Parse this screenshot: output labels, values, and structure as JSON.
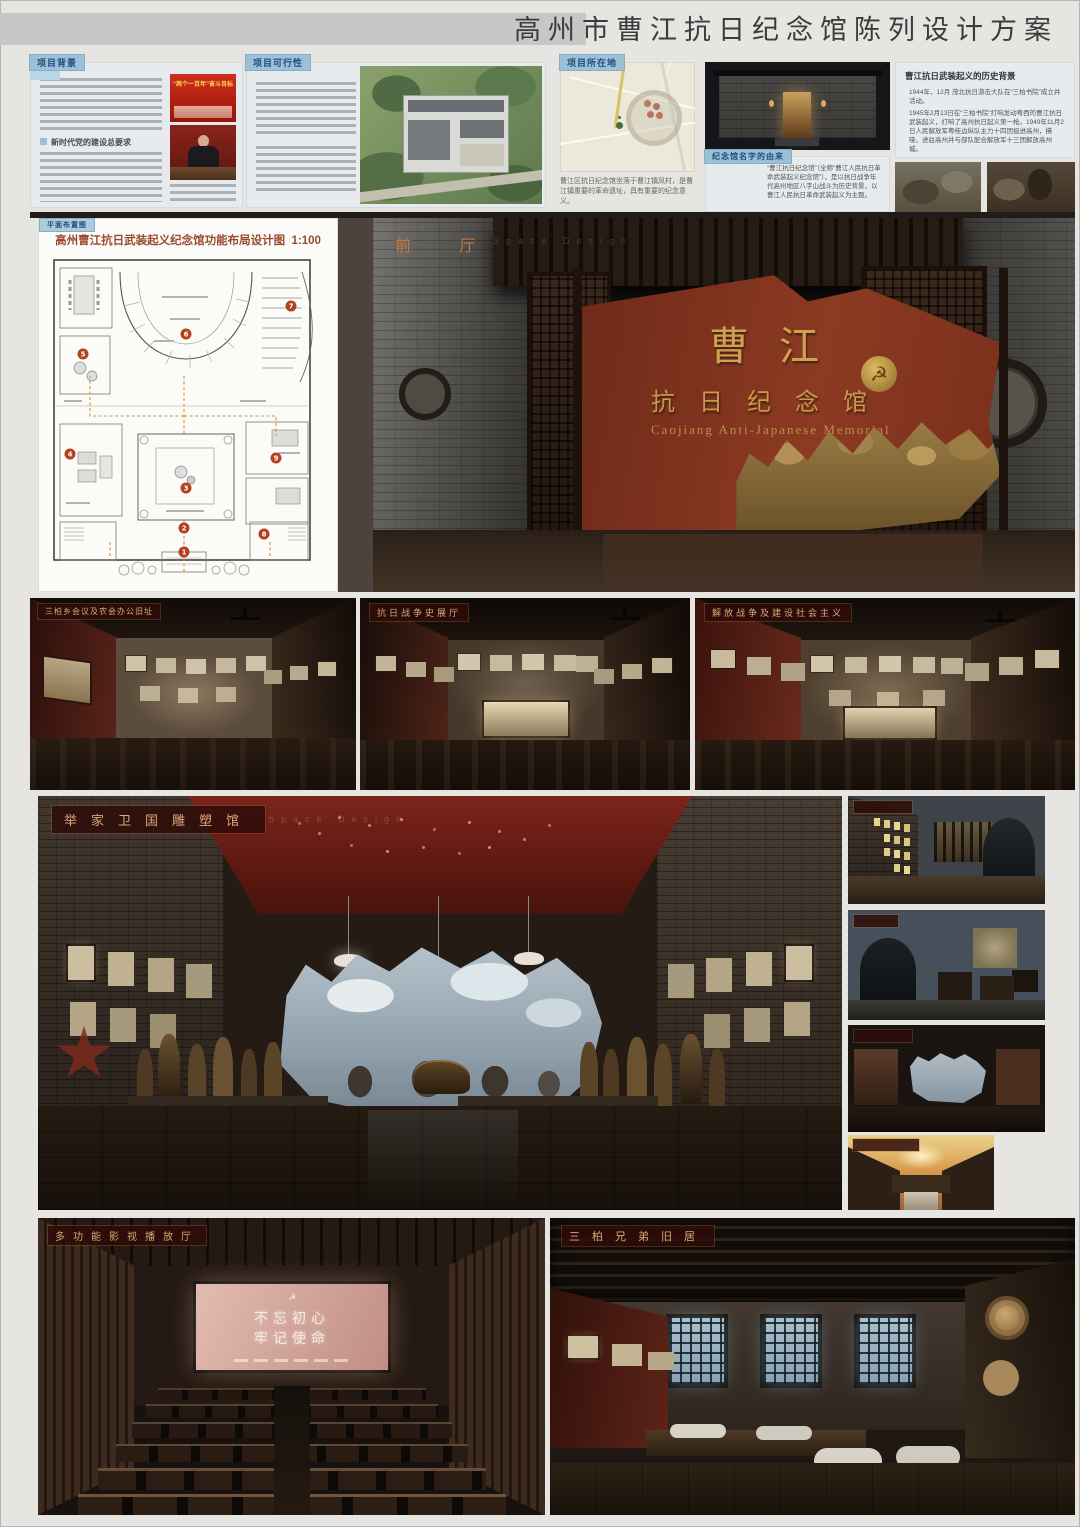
{
  "header": {
    "title": "高州市曹江抗日纪念馆陈列设计方案"
  },
  "panels": {
    "background": {
      "tag": "项目背景",
      "section_heading": "新时代党的建设总要求",
      "banner_title": "“两个一百年”奋斗目标"
    },
    "feasibility": {
      "tag": "项目可行性"
    },
    "location": {
      "tag": "项目所在地",
      "caption": "曹江区抗日纪念馆坐落于曹江镇凤村，是曹江镇重要的革命遗址，具有重要的纪念意义。"
    },
    "origin": {
      "tag": "纪念馆名字的由来",
      "text": "“曹江抗日纪念馆”（全称“曹江人民抗日革命武装起义纪念馆”），是以抗日战争年代高州地区八字山战斗为历史背景，以曹江人民抗日革命武装起义为主题。"
    },
    "history": {
      "title": "曹江抗日武装起义的历史背景",
      "p1": "1944年，12月 茂北抗日游击大队在“三柏书院”成立并活动。",
      "p2": "1945年2月13日在“三柏书院”打响发动粤西的曹江抗日武装起义，打响了高州抗日起义第一枪。1949年11月2日人民解放军粤桂边纵队主力十四团挺进高州，拂晓，进驻高州并与部队配合解放军十三团解放高州城。"
    }
  },
  "floorplan": {
    "tag": "平面布置图",
    "title": "高州曹江抗日武装起义纪念馆功能布局设计图",
    "scale": "1:100",
    "numbers": [
      "1",
      "2",
      "3",
      "4",
      "5",
      "6",
      "7",
      "8",
      "9"
    ]
  },
  "renders": {
    "lobby": {
      "label": "前 厅",
      "sub": "Space Design",
      "wall_cn_1": "曹 江",
      "wall_cn_2": "抗 日 纪 念 馆",
      "wall_en": "Caojiang Anti-Japanese Memorial"
    },
    "hall_meeting": {
      "label": "三柏乡会议及农会办公旧址"
    },
    "hall_war": {
      "label": "抗日战争史展厅"
    },
    "hall_liberation": {
      "label": "解放战争及建设社会主义"
    },
    "sculpture": {
      "label": "举家卫国雕塑馆",
      "sub": "Space Design"
    },
    "cinema": {
      "label": "多功能影视播放厅",
      "screen_line1": "不忘初心",
      "screen_line2": "牢记使命"
    },
    "residence": {
      "label": "三柏兄弟旧居"
    }
  },
  "colors": {
    "accent_red": "#8c3a22",
    "label_text": "#d9a87c",
    "tag_blue": "#9cc0d6"
  }
}
